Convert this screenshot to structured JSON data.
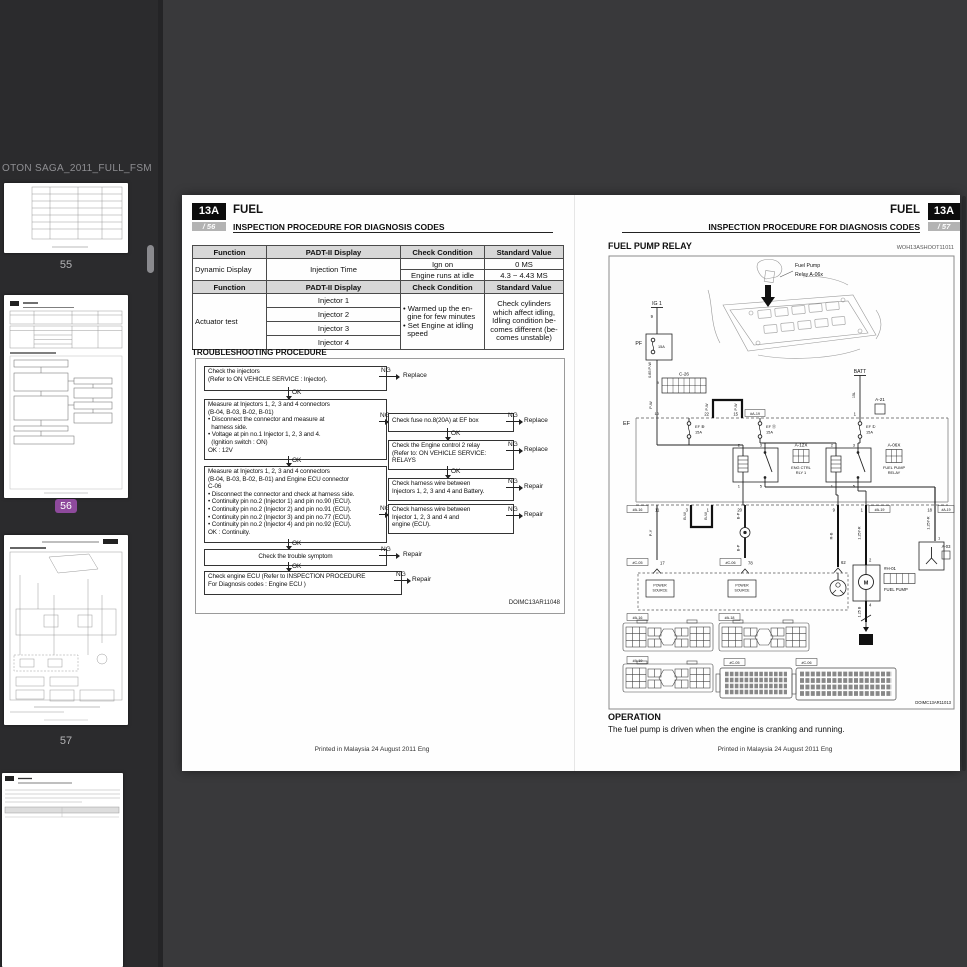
{
  "viewer": {
    "title": "OTON SAGA_2011_FULL_FSM",
    "sidebar": {
      "selected_color": "#8e4a9c",
      "items": [
        {
          "label": "55"
        },
        {
          "label": "56",
          "selected": true
        },
        {
          "label": "57"
        },
        {
          "label": ""
        }
      ]
    }
  },
  "page_left": {
    "chapter_badge": "13A",
    "chapter_title": "FUEL",
    "page_badge": "/ 56",
    "section_title": "INSPECTION PROCEDURE FOR DIAGNOSIS CODES",
    "table1": {
      "headers": [
        "Function",
        "PADT-II Display",
        "Check Condition",
        "Standard Value"
      ],
      "function": "Dynamic Display",
      "display": "Injection Time",
      "rows": [
        {
          "condition": "Ign on",
          "value": "0 MS"
        },
        {
          "condition": "Engine runs at idle",
          "value": "4.3 ~ 4.43 MS"
        }
      ]
    },
    "table2": {
      "headers": [
        "Function",
        "PADT-II Display",
        "Check Condition",
        "Standard Value"
      ],
      "function": "Actuator test",
      "displays": [
        "Injector 1",
        "Injector 2",
        "Injector 3",
        "Injector 4"
      ],
      "condition": "• Warmed up the en-\n  gine for few minutes\n• Set Engine at idling\n  speed",
      "value": "Check cylinders\nwhich affect idling,\nIdling condition be-\ncomes different (be-\ncomes unstable)"
    },
    "troubleshooting_title": "TROUBLESHOOTING PROCEDURE",
    "flowchart": {
      "ok": "OK",
      "ng": "NG",
      "replace": "Replace",
      "repair": "Repair",
      "box_a": "Check the injectors\n(Refer to ON VEHICLE SERVICE : Injector).",
      "box_b": "Measure at Injectors 1, 2, 3 and 4 connectors\n(B-04, B-03, B-02, B-01)\n• Disconnect the connector and measure at\n  harness side.\n• Voltage at pin no.1 Injector 1, 2, 3 and 4.\n  (Ignition switch : ON)\nOK : 12V",
      "box_c": "Measure at Injectors 1, 2, 3 and 4 connectors\n(B-04, B-03, B-02, B-01) and Engine ECU connector\nC-06\n• Disconnect the connector and check at harness side.\n• Continuity pin no.2 (Injector 1) and pin no.90 (ECU).\n• Continuity pin no.2 (Injector 2) and pin no.91 (ECU).\n• Continuity pin no.2 (Injector 3) and pin no.77 (ECU).\n• Continuity pin no.2 (Injector 4) and pin no.92 (ECU).\nOK : Continuity.",
      "box_d": "Check the trouble symptom",
      "box_e": "Check engine ECU (Refer to INSPECTION PROCEDURE\nFor Diagnosis codes : Engine ECU )",
      "box_r1": "Check fuse no.8(20A) at EF box",
      "box_r2": "Check the Engine control 2 relay\n(Refer to: ON VEHICLE SERVICE:\nRELAYS",
      "box_r3": "Check harness wire between\nInjectors 1, 2, 3 and 4 and Battery.",
      "box_r4": "Check harness wire between\nInjector 1, 2, 3 and 4 and\nengine (ECU)."
    },
    "diagram_code": "DOIMC13AR11048",
    "footer": "Printed in Malaysia 24 August 2011 Eng"
  },
  "page_right": {
    "chapter_title": "FUEL",
    "chapter_badge": "13A",
    "section_title": "INSPECTION PROCEDURE FOR DIAGNOSIS CODES",
    "page_badge": "/ 57",
    "heading": "FUEL PUMP RELAY",
    "heading_code": "WOH13ASHOOT11011",
    "diagram": {
      "callout_1": "Fuel Pump",
      "callout_2": "Relay A-06x",
      "ig": "IG 1",
      "ig_pin": "9",
      "pf": "PF",
      "pf_amp": "15A",
      "w_085pw": "0.85 P-W",
      "w_pw": "P-W",
      "c26": "C-26",
      "c26_pin_in": "9",
      "c26_pin_out": "10",
      "ef": "EF",
      "p22": "22",
      "p15": "15",
      "badge_a19_top": "#A-19",
      "w_pw_l": "P-W",
      "w_pw_r": "P-W",
      "batt": "BATT",
      "w_batt": "15L",
      "p1_batt": "1",
      "a21": "A-21",
      "fuse1": "EF ⑧",
      "fuse1_amp": "15A",
      "fuse2": "EF ⑪",
      "fuse2_amp": "15A",
      "fuse3": "EF ①",
      "fuse3_amp": "15A",
      "a12x": "A-12X",
      "a12x_l1": "ENG CTRL",
      "a12x_l2": "RLY 1",
      "a06x": "A-06X",
      "a06x_l1": "FUEL PUMP",
      "a06x_l2": "RELAY",
      "rp1": "1",
      "rp2": "2",
      "rp3": "3",
      "rp5": "5",
      "badge_a16": "#A-16",
      "p11": "11",
      "p3": "3",
      "p1": "1",
      "p20": "20",
      "p9": "9",
      "p1b": "1",
      "badge_a19": "#A-19",
      "p18": "18",
      "badge_a19b": "#A-19",
      "w_py": "P-Y",
      "w_bw": "B-W",
      "w_bp": "B-P",
      "w_rb": "R-B",
      "w_yr": "1.25Y-R",
      "w_yr2": "1.25Y-R",
      "w_b": "1.25 B",
      "badge_c05": "#C-05",
      "p17": "17",
      "badge_c06": "#C-06",
      "p78": "78",
      "p62": "62",
      "ps_l1": "POWER",
      "ps_l2": "SOURCE",
      "p2m": "2",
      "p4": "4",
      "h01": "#H-01",
      "motor": "M",
      "fuel_pump": "FUEL PUMP",
      "gnd13": "13",
      "a03": "A-03",
      "a03_pin": "1",
      "cb_a16": "#A-16",
      "cb_a18": "#A-18",
      "cb_a19": "#A-19",
      "cb_c05": "#C-05",
      "cb_c06": "#C-06"
    },
    "diagram_code": "DOIMC13AR11013",
    "operation_title": "OPERATION",
    "operation_text": "The fuel pump is driven when the engine is cranking and running.",
    "footer": "Printed in Malaysia 24 August 2011 Eng"
  }
}
